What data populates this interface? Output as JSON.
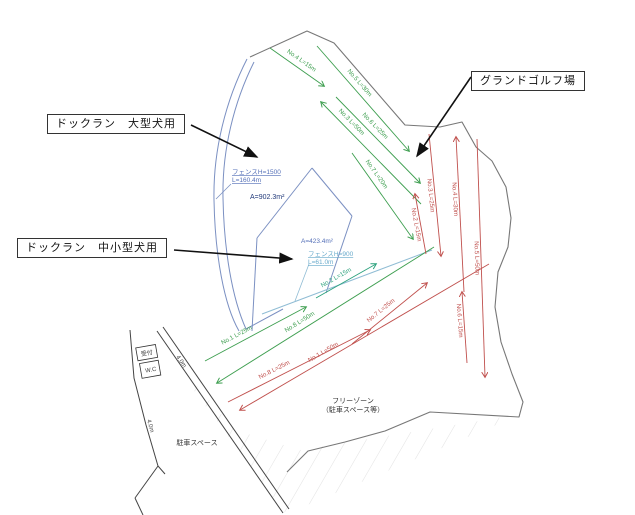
{
  "labels": {
    "dogrun_large": "ドックラン　大型犬用",
    "dogrun_small": "ドックラン　中小型犬用",
    "ground_golf": "グランドゴルフ場",
    "free_zone_line1": "フリーゾーン",
    "free_zone_line2": "（駐車スペース等）",
    "parking": "駐車スペース",
    "reception": "受付",
    "wc": "W.C",
    "fence_large_line1": "フェンスH=1500",
    "fence_large_line2": "L=160.4m",
    "fence_small_line1": "フェンスH=900",
    "fence_small_line2": "L=61.0m",
    "area_large": "A=902.3m²",
    "area_small": "A=423.4m²",
    "road_width_a": "4.0m",
    "road_width_b": "4.0m"
  },
  "colors": {
    "green": "#3d9e4f",
    "teal": "#2aa17c",
    "red": "#c0504d",
    "fence_blue": "#7b90c2",
    "fence_cyan": "#8fbcd4",
    "boundary": "#777777",
    "black": "#111111"
  },
  "golf_courses": [
    {
      "name": "green-course",
      "color_key": "green",
      "arrows": [
        {
          "label": "No.1 L=25m",
          "x1": 205,
          "y1": 361,
          "x2": 306,
          "y2": 307,
          "lt": 0.35
        },
        {
          "label": "No.2 L=15m",
          "x1": 316,
          "y1": 298,
          "x2": 376,
          "y2": 264,
          "lt": 0.4,
          "color_key": "teal"
        },
        {
          "label": "No.3 L=50m",
          "x1": 421,
          "y1": 204,
          "x2": 321,
          "y2": 102,
          "lt": 0.75
        },
        {
          "label": "No.4 L=15m",
          "x1": 270,
          "y1": 48,
          "x2": 324,
          "y2": 86,
          "lt": 0.5
        },
        {
          "label": "No.5 L=30m",
          "x1": 317,
          "y1": 46,
          "x2": 409,
          "y2": 151,
          "lt": 0.4
        },
        {
          "label": "No.6 L=25m",
          "x1": 336,
          "y1": 97,
          "x2": 420,
          "y2": 183,
          "lt": 0.4
        },
        {
          "label": "No.7 L=20m",
          "x1": 352,
          "y1": 153,
          "x2": 413,
          "y2": 239,
          "lt": 0.3
        },
        {
          "label": "No.8 L=50m",
          "x1": 434,
          "y1": 247,
          "x2": 217,
          "y2": 383,
          "lt": 0.6
        }
      ]
    },
    {
      "name": "red-course",
      "color_key": "red",
      "arrows": [
        {
          "label": "No.1 L=50m",
          "x1": 489,
          "y1": 264,
          "x2": 240,
          "y2": 410,
          "lt": 0.65
        },
        {
          "label": "No.2 L=15m",
          "x1": 426,
          "y1": 254,
          "x2": 415,
          "y2": 194,
          "lt": 0.5
        },
        {
          "label": "No.3 L=25m",
          "x1": 429,
          "y1": 134,
          "x2": 441,
          "y2": 256,
          "lt": 0.5
        },
        {
          "label": "No.4 L=30m",
          "x1": 464,
          "y1": 292,
          "x2": 456,
          "y2": 137,
          "lt": 0.6
        },
        {
          "label": "No.5 L=50m",
          "x1": 477,
          "y1": 139,
          "x2": 485,
          "y2": 377,
          "lt": 0.5
        },
        {
          "label": "No.6 L=15m",
          "x1": 467,
          "y1": 363,
          "x2": 462,
          "y2": 292,
          "lt": 0.6
        },
        {
          "label": "No.7 L=25m",
          "x1": 352,
          "y1": 344,
          "x2": 427,
          "y2": 283,
          "lt": 0.45
        },
        {
          "label": "No.8 L=25m",
          "x1": 228,
          "y1": 402,
          "x2": 370,
          "y2": 330,
          "lt": 0.35
        }
      ]
    }
  ]
}
